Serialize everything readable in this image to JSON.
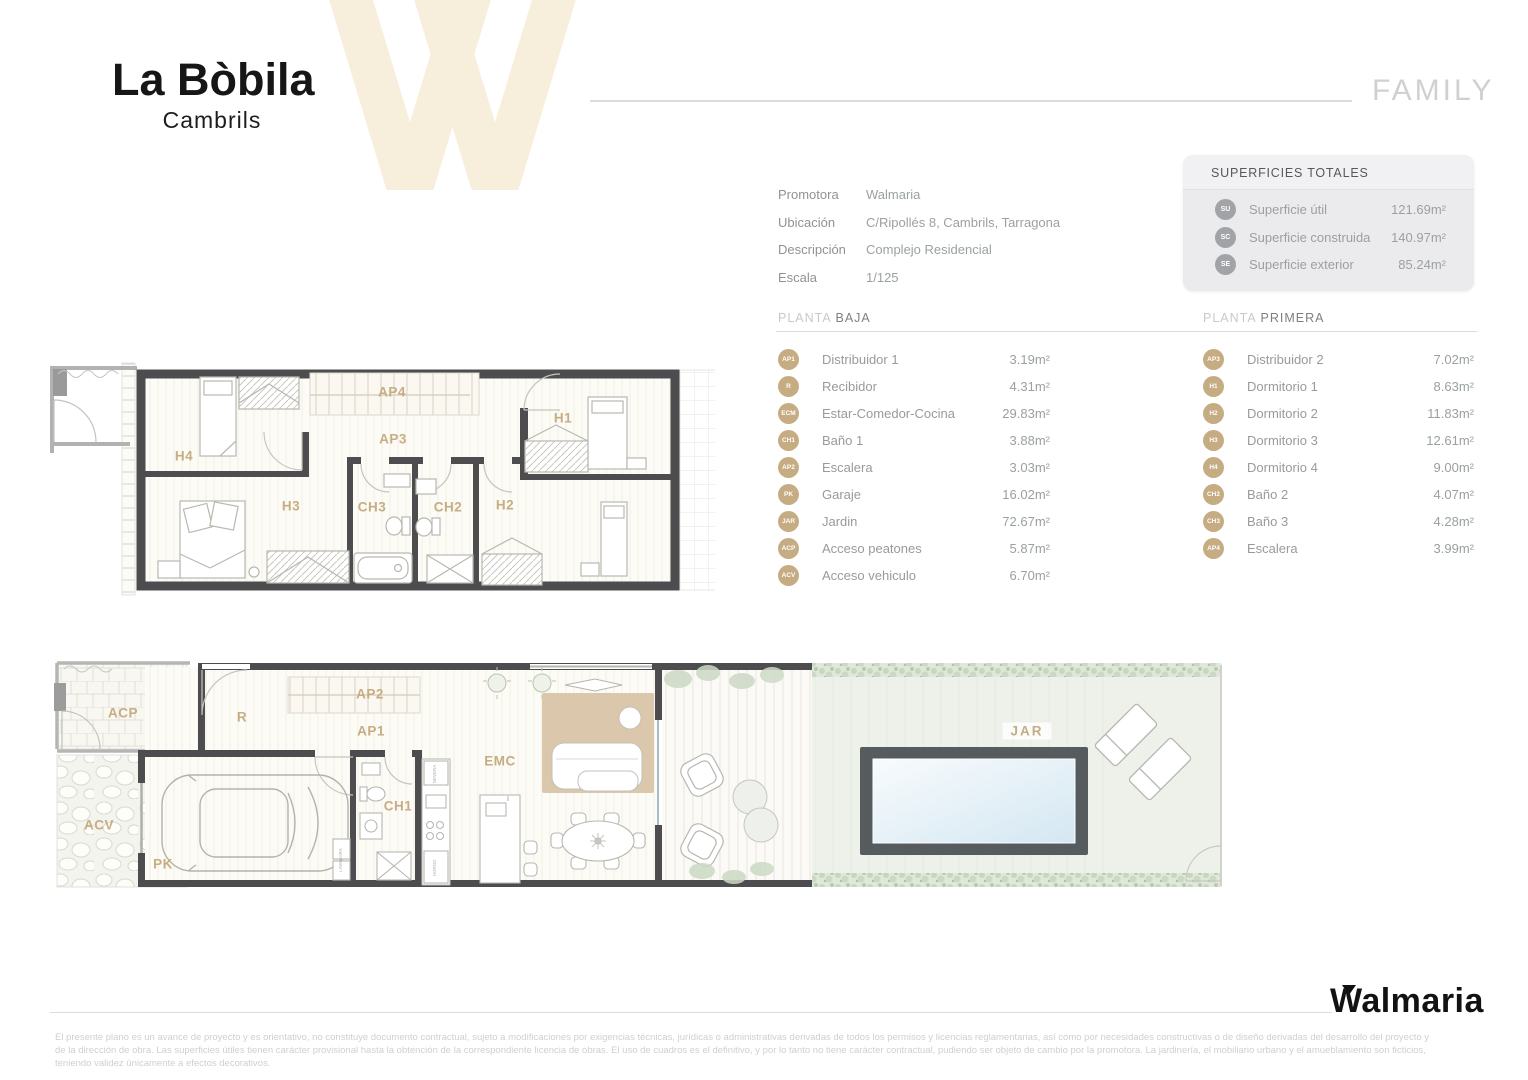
{
  "header": {
    "title": "La Bòbila",
    "subtitle": "Cambrils",
    "plan_type": "FAMILY"
  },
  "info": {
    "rows": [
      {
        "label": "Promotora",
        "value": "Walmaria"
      },
      {
        "label": "Ubicación",
        "value": "C/Ripollés 8, Cambrils, Tarragona"
      },
      {
        "label": "Descripción",
        "value": "Complejo Residencial"
      },
      {
        "label": "Escala",
        "value": "1/125"
      }
    ]
  },
  "totals": {
    "title": "SUPERFICIES TOTALES",
    "rows": [
      {
        "badge": "SU",
        "label": "Superficie útil",
        "value": "121.69m²"
      },
      {
        "badge": "SC",
        "label": "Superficie construida",
        "value": "140.97m²"
      },
      {
        "badge": "SE",
        "label": "Superficie exterior",
        "value": "85.24m²"
      }
    ]
  },
  "planta_baja": {
    "title_light": "PLANTA",
    "title_bold": "BAJA",
    "rows": [
      {
        "badge": "AP1",
        "name": "Distribuidor 1",
        "value": "3.19m²"
      },
      {
        "badge": "R",
        "name": "Recibidor",
        "value": "4.31m²"
      },
      {
        "badge": "ECM",
        "name": "Estar-Comedor-Cocina",
        "value": "29.83m²"
      },
      {
        "badge": "CH1",
        "name": "Baño 1",
        "value": "3.88m²"
      },
      {
        "badge": "AP2",
        "name": "Escalera",
        "value": "3.03m²"
      },
      {
        "badge": "PK",
        "name": "Garaje",
        "value": "16.02m²"
      },
      {
        "badge": "JAR",
        "name": "Jardin",
        "value": "72.67m²"
      },
      {
        "badge": "ACP",
        "name": "Acceso peatones",
        "value": "5.87m²"
      },
      {
        "badge": "ACV",
        "name": "Acceso vehiculo",
        "value": "6.70m²"
      }
    ]
  },
  "planta_primera": {
    "title_light": "PLANTA",
    "title_bold": "PRIMERA",
    "rows": [
      {
        "badge": "AP3",
        "name": "Distribuidor 2",
        "value": "7.02m²"
      },
      {
        "badge": "H1",
        "name": "Dormitorio 1",
        "value": "8.63m²"
      },
      {
        "badge": "H2",
        "name": "Dormitorio 2",
        "value": "11.83m²"
      },
      {
        "badge": "H3",
        "name": "Dormitorio 3",
        "value": "12.61m²"
      },
      {
        "badge": "H4",
        "name": "Dormitorio 4",
        "value": "9.00m²"
      },
      {
        "badge": "CH2",
        "name": "Baño 2",
        "value": "4.07m²"
      },
      {
        "badge": "CH3",
        "name": "Baño 3",
        "value": "4.28m²"
      },
      {
        "badge": "AP4",
        "name": "Escalera",
        "value": "3.99m²"
      }
    ]
  },
  "plan_top": {
    "labels": {
      "h4": "H4",
      "ap4": "AP4",
      "ap3": "AP3",
      "h1": "H1",
      "h3": "H3",
      "ch3": "CH3",
      "ch2": "CH2",
      "h2": "H2"
    }
  },
  "plan_bottom": {
    "labels": {
      "acp": "ACP",
      "r": "R",
      "ap2": "AP2",
      "ap1": "AP1",
      "acv": "ACV",
      "pk": "PK",
      "ch1": "CH1",
      "emc": "EMC",
      "jar": "JAR"
    },
    "equipment": {
      "nevera": "NEVERA",
      "horno": "HORNO",
      "lavadora": "LAVADORA"
    }
  },
  "footer": {
    "brand": "Walmaria",
    "disclaimer1": "El presente plano es un avance de proyecto y es orientativo, no constituye documento contractual, sujeto a modificaciones por exigencias técnicas, jurídicas o administrativas derivadas de todos los permisos y licencias reglamentarias, así como por necesidades constructivas o de diseño derivadas del desarrollo del proyecto y",
    "disclaimer2": "de la dirección de obra. Las superficies útiles tienen carácter provisional hasta la obtención de la correspondiente licencia de obras. El uso de cuadros es el definitivo, y por lo tanto no tiene carácter contractual, pudiendo ser objeto de cambio por la promotora. La jardinería, el mobiliario urbano y el amueblamiento son ficticios,",
    "disclaimer3": "teniendo validez únicamente a efectos decorativos."
  },
  "colors": {
    "accent_tan": "#c6ac82",
    "badge_gray": "#a2a3a7",
    "wall": "#4d4d4f",
    "pool_border": "#565b5e",
    "pool_water": "#d4e7f2",
    "garden": "#edf1ea",
    "watermark_cream": "#f7eedc"
  }
}
